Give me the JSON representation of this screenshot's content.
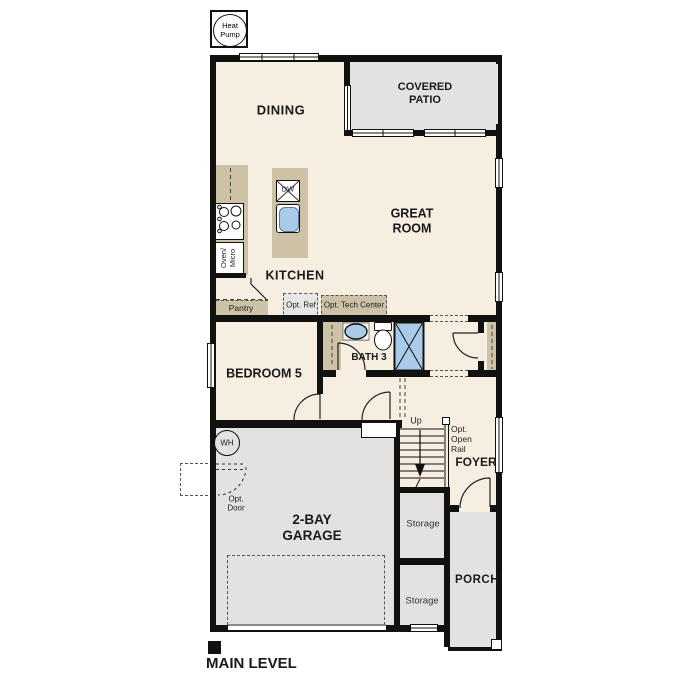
{
  "colors": {
    "wall": "#111111",
    "interior": "#f6eee0",
    "exterior_concrete": "#e3e2e0",
    "casework": "#cdc1a6",
    "fixture_blue": "#aacae9",
    "optional_gray": "#e7e7e7"
  },
  "badges": {
    "heat_pump": "Heat Pump"
  },
  "rooms": {
    "dining": "DINING",
    "covered_patio": "COVERED PATIO",
    "great_room": "GREAT ROOM",
    "kitchen": "KITCHEN",
    "bedroom5": "BEDROOM 5",
    "bath3": "BATH 3",
    "garage": "2-BAY GARAGE",
    "foyer": "FOYER",
    "porch": "PORCH",
    "storage_upper": "Storage",
    "storage_lower": "Storage"
  },
  "annotations": {
    "pantry": "Pantry",
    "opt_ref": "Opt. Ref",
    "opt_tech_center": "Opt. Tech Center",
    "oven_micro": "Oven/ Micro",
    "dishwasher": "DW",
    "water_heater": "WH",
    "opt_door": "Opt. Door",
    "up": "Up",
    "opt_open_rail": "Opt. Open Rail"
  },
  "footer": {
    "level_label": "MAIN LEVEL"
  }
}
